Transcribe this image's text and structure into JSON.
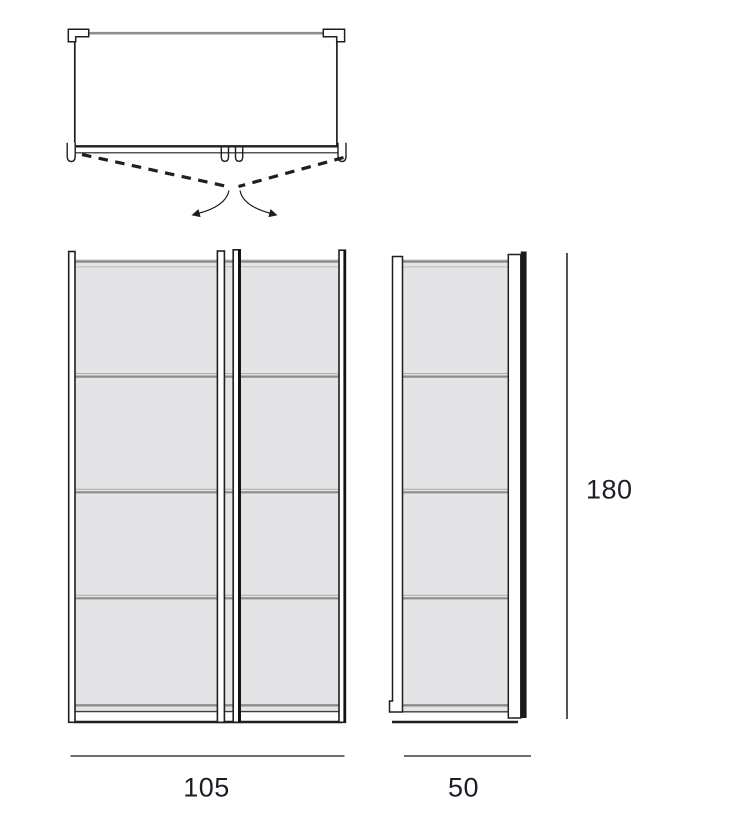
{
  "drawing": {
    "views": [
      {
        "name": "plan-view-doors-open"
      },
      {
        "name": "front-elevation"
      },
      {
        "name": "side-elevation"
      }
    ],
    "structure": {
      "door_count": 2,
      "sections_per_door": 4,
      "shelf_divider_count": 3
    }
  },
  "dimensions": {
    "width": "105",
    "depth": "50",
    "height": "180"
  },
  "colors": {
    "outline": "#1f1f1f",
    "edge_gray": "#8c8c8c",
    "edge_gray_light": "#bdbdbd",
    "divider_gray": "#9a9a9a",
    "panel_fill": "#e4e4e6",
    "plinth_fill": "#ffffff",
    "dark_bar": "#1a1a1a",
    "dimension_line": "#3f3f3f",
    "dimension_text": "#1d1d27",
    "background": "#ffffff"
  }
}
